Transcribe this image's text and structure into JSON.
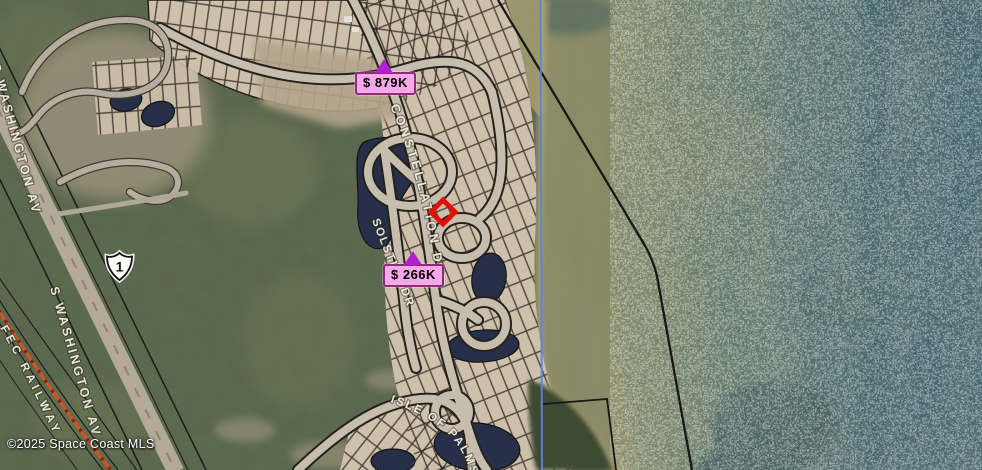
{
  "map": {
    "attribution": "©2025 Space Coast MLS",
    "route_shield": "1",
    "streets": {
      "constellation": "CONSTELLATION DR",
      "solstice": "SOLSTICE DR",
      "isle_of_palms": "ISLE OF PALMS",
      "washington_upper": "S WASHINGTON AV",
      "washington_lower": "S WASHINGTON AV",
      "fec_railway": "FEC RAILWAY"
    },
    "markers": {
      "listing_1": {
        "price": "$ 879K"
      },
      "listing_2": {
        "price": "$ 266K"
      },
      "subject": "red-diamond-selected-property"
    },
    "colors": {
      "price_label_bg": "#f6a8e8",
      "price_label_border": "#8f2b78",
      "price_pointer": "#b51fd0",
      "subject_marker": "#e01206",
      "boundary_line": "#5a80d8",
      "parcel_line": "#101010",
      "railway": "#cf4e22"
    }
  }
}
